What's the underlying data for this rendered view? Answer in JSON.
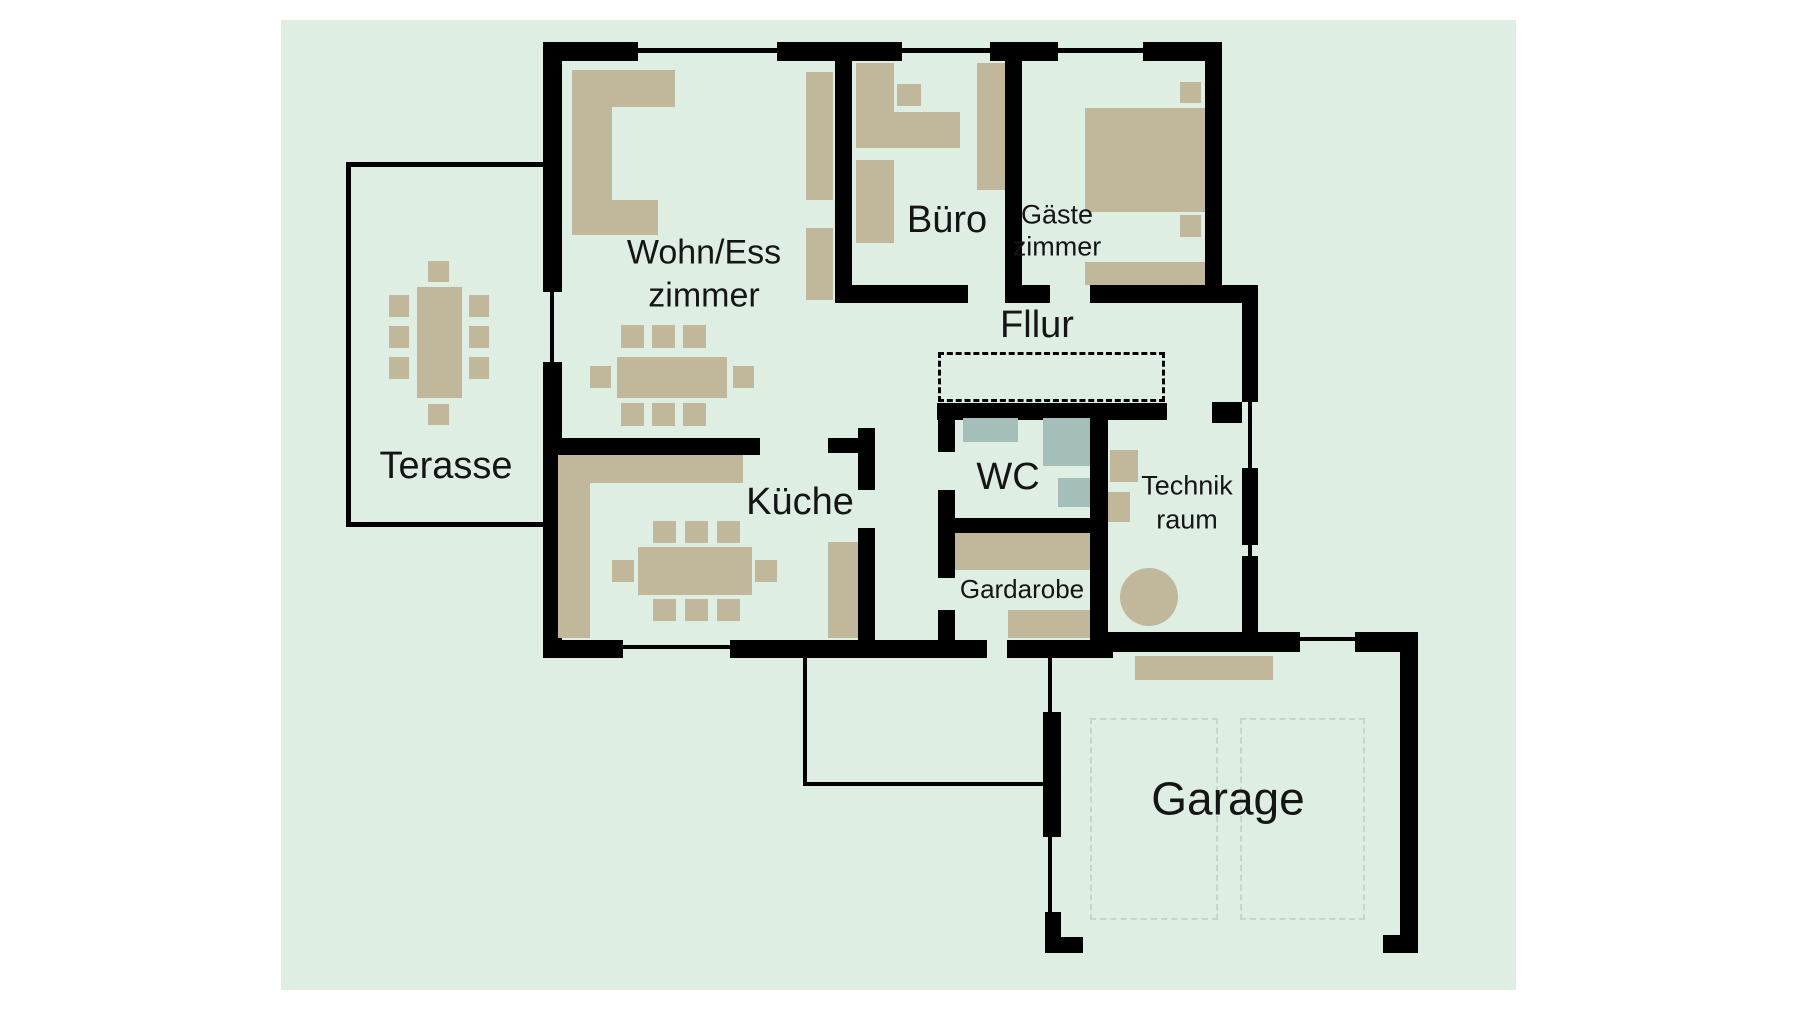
{
  "plan": {
    "colors": {
      "page_background": "#ffffff",
      "canvas_background": "#dfeee2",
      "wall": "#000000",
      "furniture": "#c1b79b",
      "wc_fixture": "#a4bfba",
      "parking_dash": "#c6d6c6",
      "text": "#151515"
    },
    "rooms": {
      "terasse": {
        "label": "Terasse"
      },
      "wohn_ess": {
        "label_line1": "Wohn/Ess",
        "label_line2": "zimmer"
      },
      "buero": {
        "label": "Büro"
      },
      "gaeste": {
        "label_line1": "Gäste",
        "label_line2": "zimmer"
      },
      "flur": {
        "label": "Fllur"
      },
      "kueche": {
        "label": "Küche"
      },
      "wc": {
        "label": "WC"
      },
      "technik": {
        "label_line1": "Technik",
        "label_line2": "raum"
      },
      "gardarobe": {
        "label": "Gardarobe"
      },
      "garage": {
        "label": "Garage"
      }
    }
  }
}
